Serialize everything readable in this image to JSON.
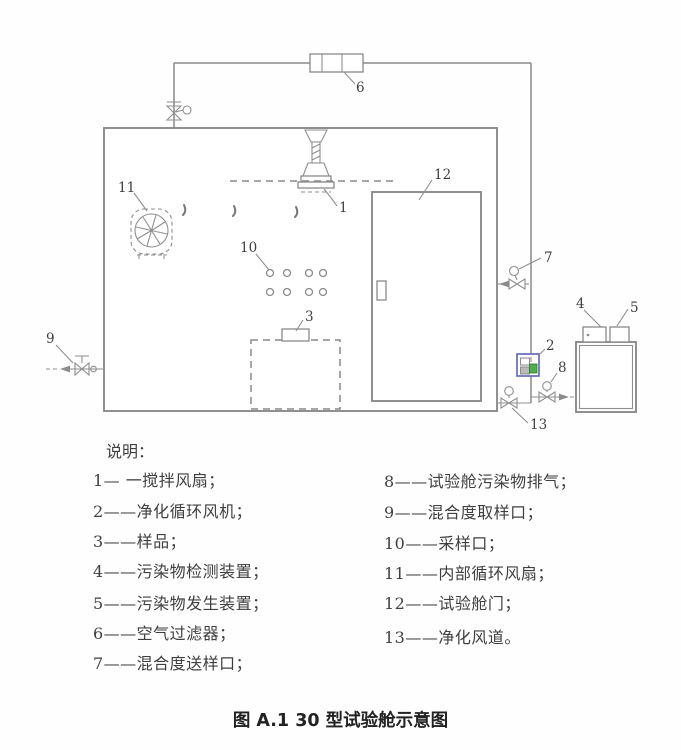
{
  "diagram": {
    "part_labels": {
      "p1": "1",
      "p2": "2",
      "p3": "3",
      "p4": "4",
      "p5": "5",
      "p6": "6",
      "p7": "7",
      "p8": "8",
      "p9": "9",
      "p10": "10",
      "p11": "11",
      "p12": "12",
      "p13": "13"
    }
  },
  "legend": {
    "title": "说明：",
    "left_items": [
      "1— 一搅拌风扇；",
      "2——净化循环风机；",
      "3——样品；",
      "4——污染物检测装置；",
      "5——污染物发生装置；",
      "6——空气过滤器；",
      "7——混合度送样口；"
    ],
    "right_items": [
      "8——试验舱污染物排气；",
      "9——混合度取样口；",
      "10——采样口；",
      "11——内部循环风扇；",
      "12——试验舱门；",
      "13——净化风道。"
    ]
  },
  "caption": "图 A.1  30 型试验舱示意图",
  "colors": {
    "line": "#8a8a8a",
    "text": "#3f3f3f",
    "highlight_border": "#5a62b5",
    "highlight_fill": "#4fae4a"
  }
}
